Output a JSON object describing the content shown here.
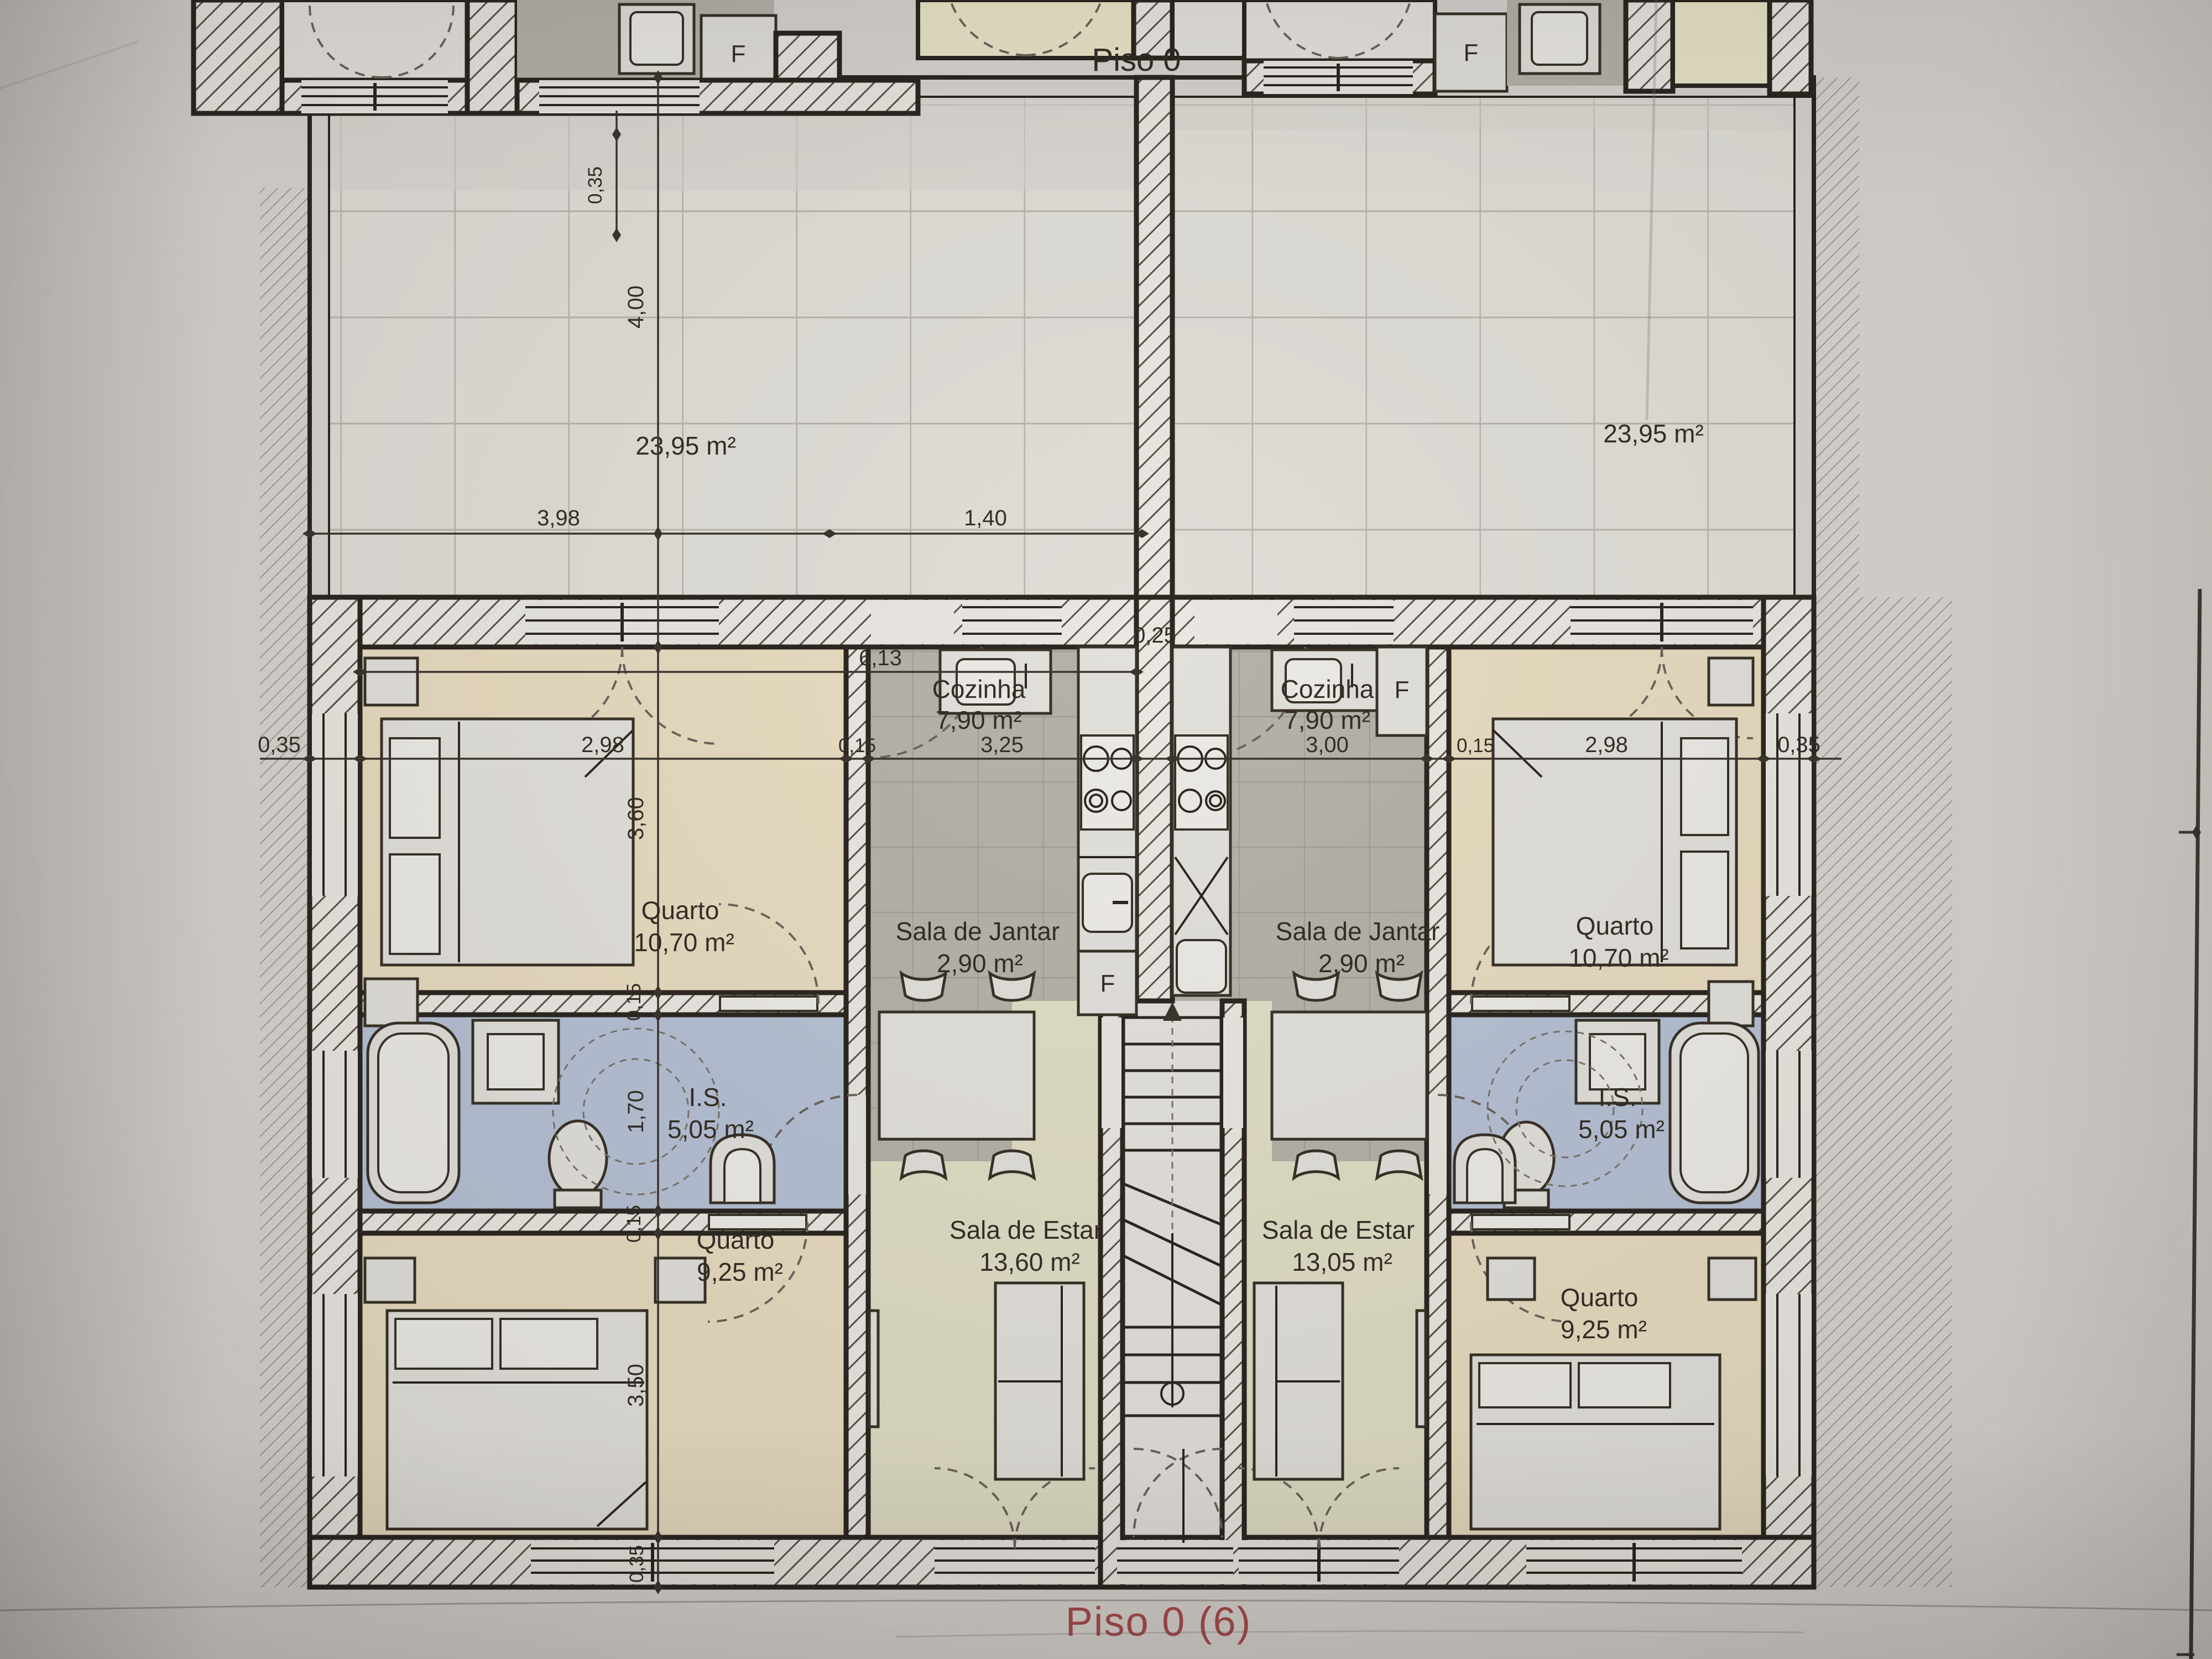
{
  "title": "Piso 0",
  "footer": "Piso 0 (6)",
  "upper_floor": {
    "fridge_left": "F",
    "fridge_right": "F",
    "dim_wall": "0,35"
  },
  "terraces": {
    "left_area": "23,95 m²",
    "right_area": "23,95 m²"
  },
  "apartments": {
    "left": {
      "quarto1_name": "Quarto",
      "quarto1_area": "10,70 m²",
      "cozinha_name": "Cozinha",
      "cozinha_area": "7,90 m²",
      "sala_jantar_name": "Sala de Jantar",
      "sala_jantar_area": "2,90 m²",
      "is_name": "I.S.",
      "is_area": "5,05 m²",
      "sala_estar_name": "Sala de Estar",
      "sala_estar_area": "13,60 m²",
      "quarto2_name": "Quarto",
      "quarto2_area": "9,25 m²",
      "fridge": "F"
    },
    "right": {
      "quarto1_name": "Quarto",
      "quarto1_area": "10,70 m²",
      "cozinha_name": "Cozinha",
      "cozinha_area": "7,90 m²",
      "sala_jantar_name": "Sala de Jantar",
      "sala_jantar_area": "2,90 m²",
      "is_name": "I.S.",
      "is_area": "5,05 m²",
      "sala_estar_name": "Sala de Estar",
      "sala_estar_area": "13,05 m²",
      "quarto2_name": "Quarto",
      "quarto2_area": "9,25 m²",
      "fridge": "F"
    }
  },
  "dims": {
    "terrace_depth": "4,00",
    "terrace_width": "3,98",
    "terrace_door": "1,40",
    "apt_total": "6,13",
    "wall_outer_left": "0,35",
    "quarto1_left": "2,98",
    "wall_inner_left": "0,15",
    "cozinha_left": "3,25",
    "wall_central": "0,25",
    "cozinha_right": "3,00",
    "wall_inner_right": "0,15",
    "quarto1_right": "2,98",
    "wall_outer_right": "0,35",
    "quarto1_height": "3,60",
    "wall_is_top": "0,15",
    "is_height": "1,70",
    "wall_is_bottom": "0,15",
    "quarto2_height": "3,50",
    "wall_bottom": "0,35"
  }
}
